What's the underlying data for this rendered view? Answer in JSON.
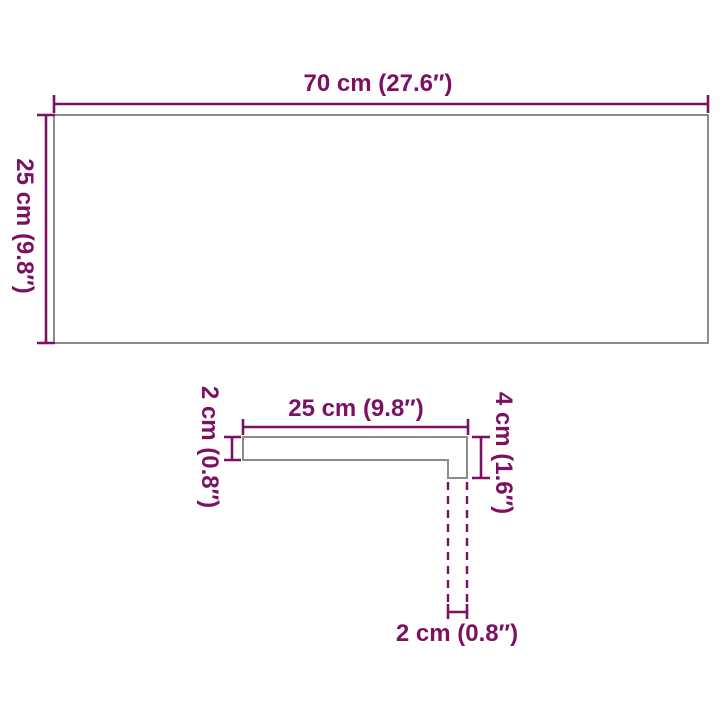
{
  "colors": {
    "dimension": "#7C1163",
    "outline": "#8C8C8C",
    "background": "#FFFFFF"
  },
  "top_view": {
    "width_label": "70 cm (27.6″)",
    "height_label": "25 cm (9.8″)"
  },
  "profile_view": {
    "width_label": "25 cm (9.8″)",
    "thickness_label": "2 cm (0.8″)",
    "height_label": "4 cm (1.6″)",
    "depth_label": "2 cm (0.8″)"
  }
}
